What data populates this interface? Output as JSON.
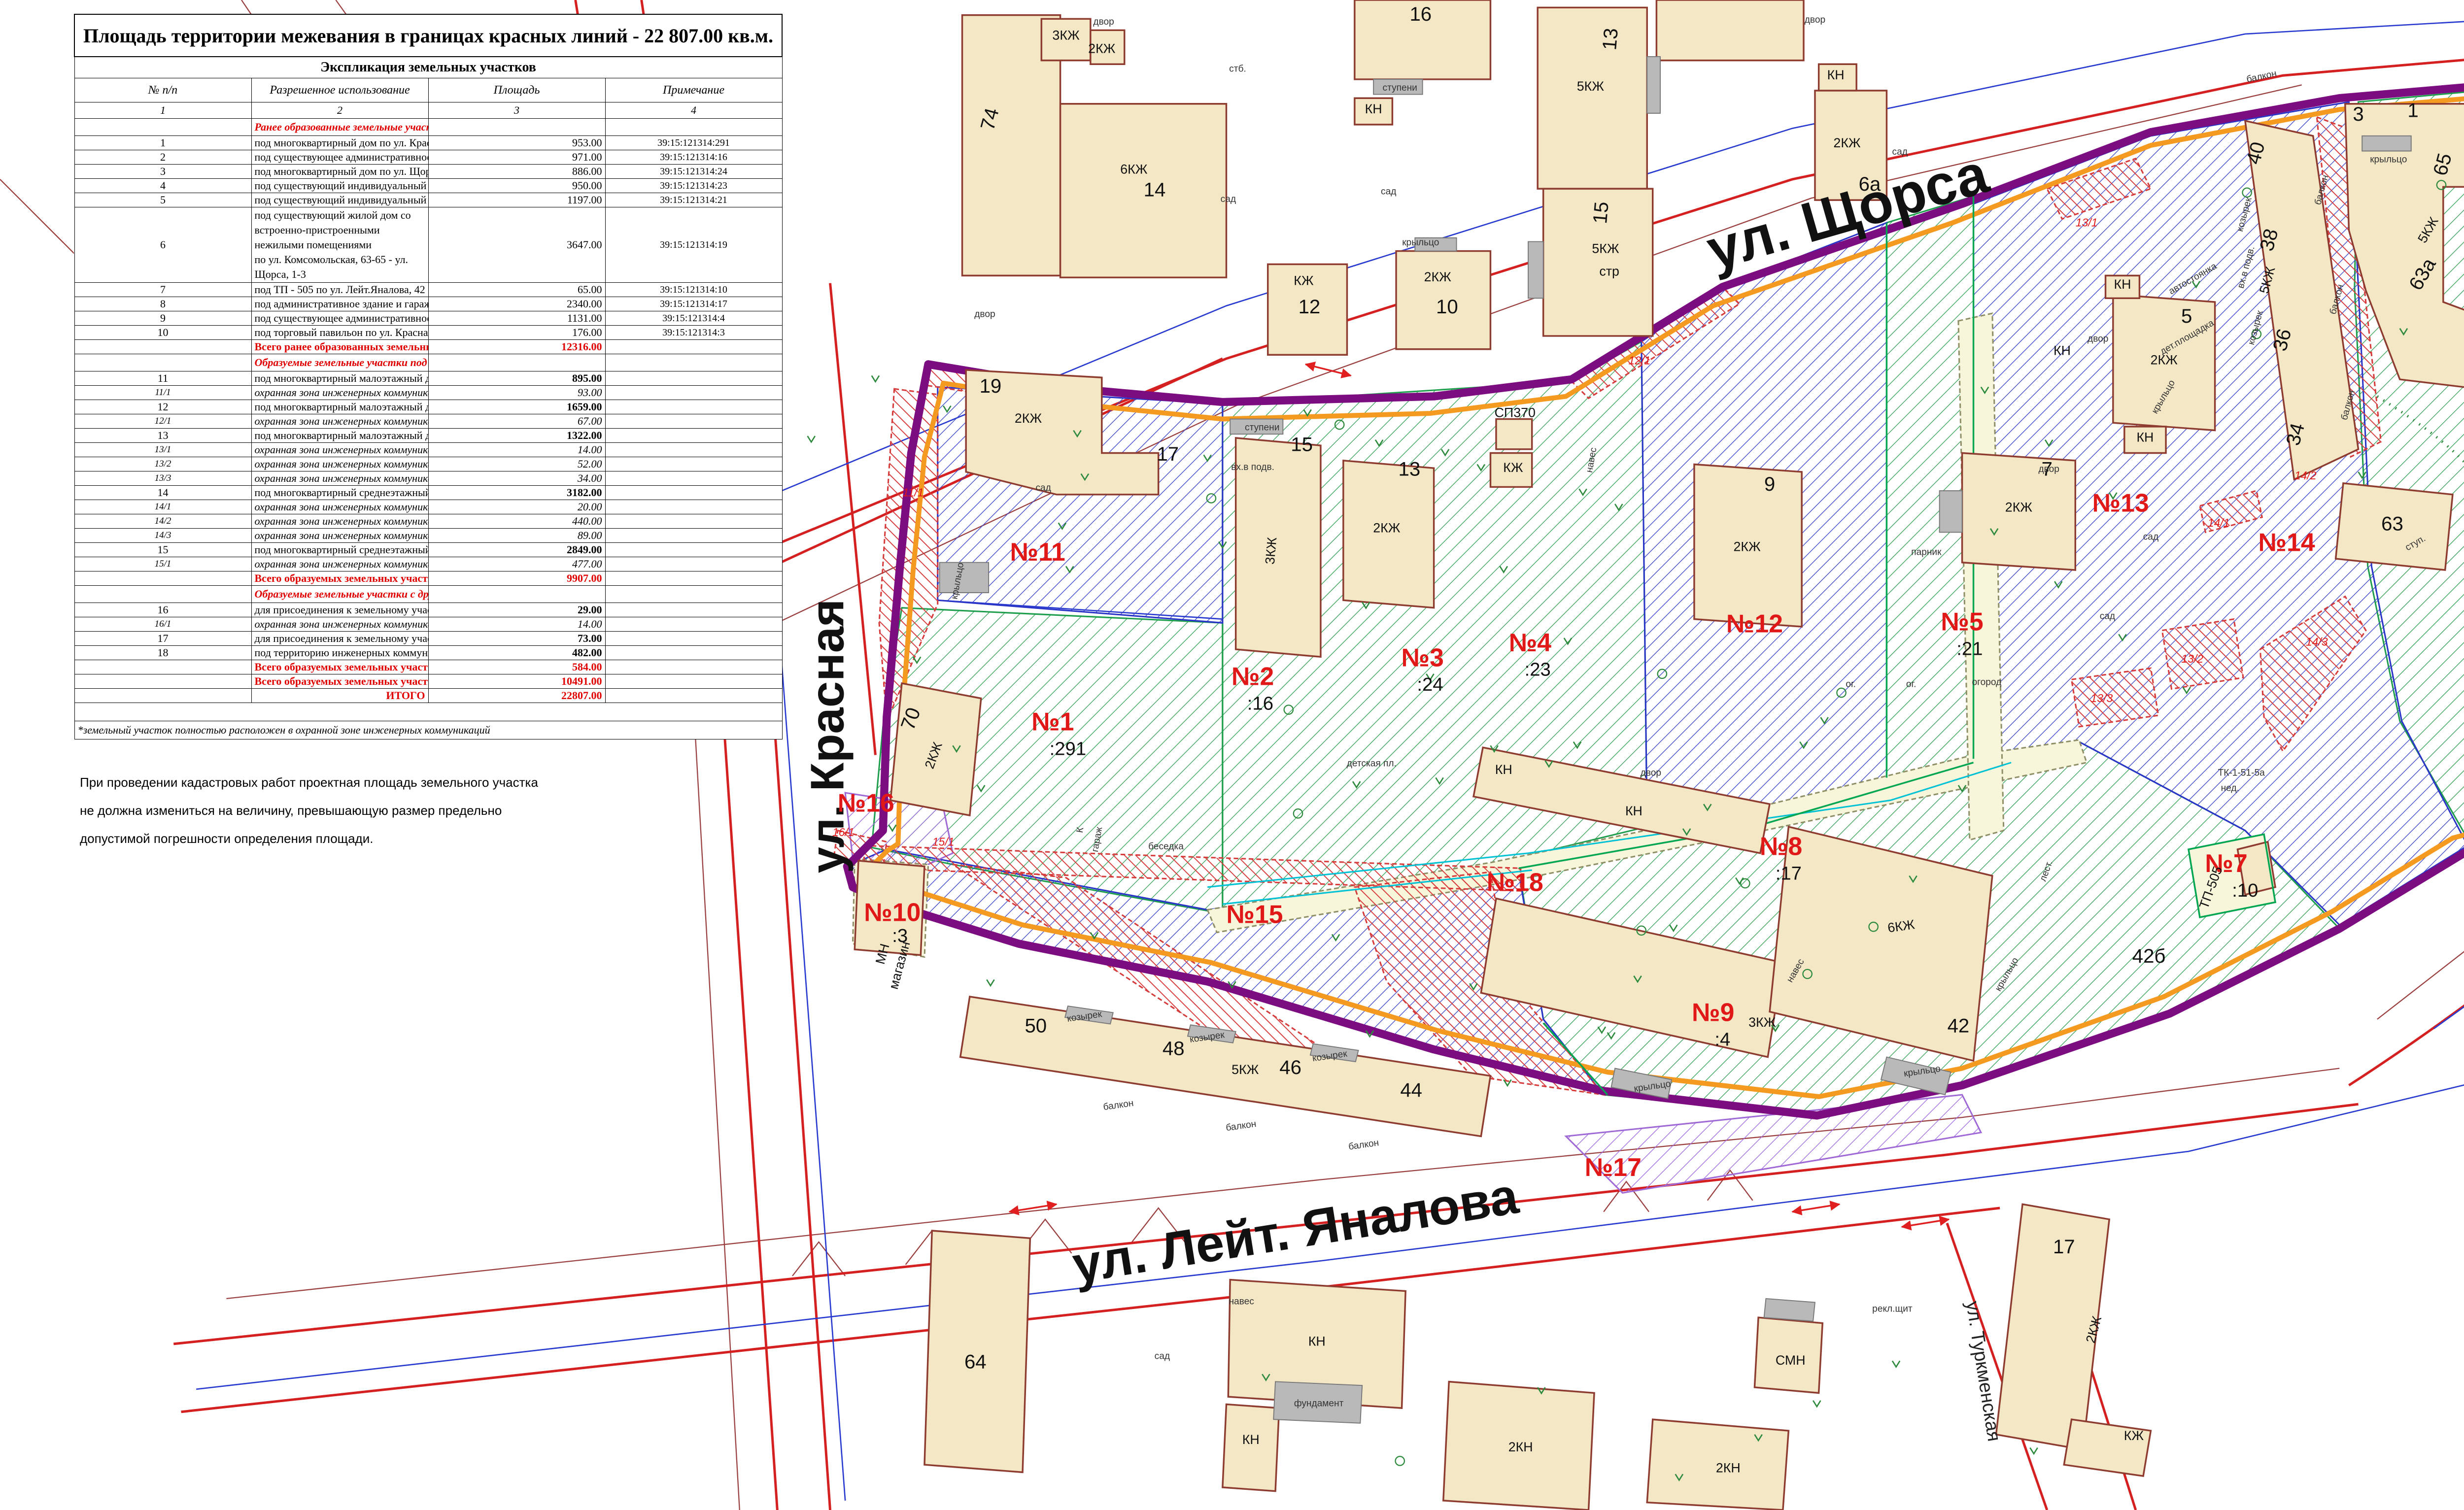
{
  "cadastral_box": {
    "label": "Кадастровый квартал",
    "value": "39:15:121314"
  },
  "table": {
    "title": "Площадь территории межевания в границах красных линий - 22 807.00 кв.м.",
    "subtitle": "Экспликация земельных участков",
    "columns": [
      "№ п/п",
      "Разрешенное использование",
      "Площадь",
      "Примечание"
    ],
    "column_numbers": [
      "1",
      "2",
      "3",
      "4"
    ],
    "rows": [
      {
        "k": "sec",
        "text": "Ранее образованные земельные участки:"
      },
      {
        "k": "r",
        "n": "1",
        "text": "под многоквартирный дом по ул. Красная, 70",
        "a": "953.00",
        "p": "39:15:121314:291"
      },
      {
        "k": "r",
        "n": "2",
        "text": "под существующее административное здание банка по ул. Щорса, 15",
        "a": "971.00",
        "p": "39:15:121314:16"
      },
      {
        "k": "r",
        "n": "3",
        "text": "под многоквартирный дом по ул. Щорса, 13",
        "a": "886.00",
        "p": "39:15:121314:24"
      },
      {
        "k": "r",
        "n": "4",
        "text": "под существующий индивидуальный жилой дом по ул. Щорса, 11",
        "a": "950.00",
        "p": "39:15:121314:23"
      },
      {
        "k": "r",
        "n": "5",
        "text": "под существующий индивидуальный жилой дом по ул. Щорса, 7",
        "a": "1197.00",
        "p": "39:15:121314:21"
      },
      {
        "k": "r2",
        "n": "6",
        "line1": "под существующий жилой дом со встроенно-пристроенными нежилыми помещениями",
        "line2": "по ул. Комсомольская, 63-65 - ул. Щорса, 1-3",
        "a": "3647.00",
        "p": "39:15:121314:19"
      },
      {
        "k": "r",
        "n": "7",
        "text": "под ТП - 505 по ул. Лейт.Яналова, 42",
        "a": "65.00",
        "p": "39:15:121314:10"
      },
      {
        "k": "r",
        "n": "8",
        "text": "под административное здание и гаражи для служебного транспорта по ул. Лейт.Яналова, 42",
        "a": "2340.00",
        "p": "39:15:121314:17"
      },
      {
        "k": "r",
        "n": "9",
        "text": "под существующее административное здание по ул. Лейт.Яналова, 42",
        "a": "1131.00",
        "p": "39:15:121314:4"
      },
      {
        "k": "r",
        "n": "10",
        "text": "под торговый павильон по ул. Красная - ул. Лейт.Яналова",
        "a": "176.00",
        "p": "39:15:121314:3"
      },
      {
        "k": "tot",
        "text": "Всего ранее образованных земельных участков",
        "a": "12316.00"
      },
      {
        "k": "sec",
        "text": "Образуемые земельные участки под многоквартирные дома, в т.ч.:"
      },
      {
        "k": "rb",
        "n": "11",
        "text": "под многоквартирный малоэтажный дом по ул. Щорса, 17-19",
        "a": "895.00"
      },
      {
        "k": "sub",
        "n": "11/1",
        "text": "охранная зона инженерных коммуникаций",
        "a": "93.00"
      },
      {
        "k": "rb",
        "n": "12",
        "text": "под многоквартирный малоэтажный дом по ул. Щорса, 9",
        "a": "1659.00"
      },
      {
        "k": "sub",
        "n": "12/1",
        "text": "охранная зона инженерных коммуникаций",
        "a": "67.00"
      },
      {
        "k": "rb",
        "n": "13",
        "text": "под многоквартирный малоэтажный дом по ул. Щорса, 5",
        "a": "1322.00"
      },
      {
        "k": "sub",
        "n": "13/1",
        "text": "охранная зона инженерных коммуникаций",
        "a": "14.00"
      },
      {
        "k": "sub",
        "n": "13/2",
        "text": "охранная зона инженерных коммуникаций",
        "a": "52.00"
      },
      {
        "k": "sub",
        "n": "13/3",
        "text": "охранная зона инженерных коммуникаций",
        "a": "34.00"
      },
      {
        "k": "rb",
        "n": "14",
        "text": "под многоквартирный среднеэтажный дом по ул. Лейт.Яналова, 34-40",
        "a": "3182.00"
      },
      {
        "k": "sub",
        "n": "14/1",
        "text": "охранная зона инженерных коммуникаций",
        "a": "20.00"
      },
      {
        "k": "sub",
        "n": "14/2",
        "text": "охранная зона инженерных коммуникаций",
        "a": "440.00"
      },
      {
        "k": "sub",
        "n": "14/3",
        "text": "охранная зона инженерных коммуникаций",
        "a": "89.00"
      },
      {
        "k": "rb",
        "n": "15",
        "text": "под многоквартирный среднеэтажный дом по ул. Лейт.Яналова, 44-50",
        "a": "2849.00"
      },
      {
        "k": "sub",
        "n": "15/1",
        "text": "охранная зона инженерных коммуникаций",
        "a": "477.00"
      },
      {
        "k": "tot",
        "text": "Всего образуемых земельных участков под многоквартирные дома",
        "a": "9907.00"
      },
      {
        "k": "sec",
        "text": "Образуемые земельные участки с другим разрешённым использованием, в т.ч.:"
      },
      {
        "k": "rb",
        "n": "16",
        "text": "для присоединения к земельному участку с кадастровым номером 39:15:121314:291 по ул. Красная",
        "a": "29.00"
      },
      {
        "k": "sub",
        "n": "16/1",
        "text": "охранная зона инженерных коммуникаций",
        "a": "14.00"
      },
      {
        "k": "rb",
        "n": "17",
        "text": "для присоединения к земельному участку с кадастровым номером 39:15:121314:4 по ул. Лейт.Яналова",
        "a": "73.00"
      },
      {
        "k": "rb",
        "n": "18",
        "text": "под территорию инженерных коммуникаций по ул. Щорса - ул. Лейт.Яналова",
        "a": "482.00"
      },
      {
        "k": "tot",
        "text": "Всего образуемых земельных участков с другим разрешённым использованием",
        "a": "584.00"
      },
      {
        "k": "tot",
        "text": "Всего образуемых земельных участков",
        "a": "10491.00"
      },
      {
        "k": "tot",
        "text": "ИТОГО",
        "a": "22807.00"
      },
      {
        "k": "blank"
      },
      {
        "k": "foot",
        "text": "*земельный участок полностью расположен в охранной зоне инженерных коммуникаций"
      }
    ]
  },
  "note_below": {
    "lines": [
      "При проведении кадастровых работ проектная площадь земельного участка",
      "не должна измениться на величину, превышающую размер предельно",
      "допустимой погрешности определения площади."
    ]
  },
  "legend": {
    "title": "УСЛОВНЫЕ ОБОЗНАЧЕНИЯ:",
    "items": [
      {
        "type": "line",
        "color": "#e22020",
        "w": 2,
        "label": "- красные линии"
      },
      {
        "type": "line",
        "color": "#7c0d80",
        "w": 7,
        "label": "- граница территории межевания"
      },
      {
        "type": "line",
        "color": "#f49a20",
        "w": 7,
        "label": "- линия отступа от красных линий"
      },
      {
        "type": "line",
        "color": "#3b4fd0",
        "w": 1.6,
        "label": "- граница кадастрового квартала"
      },
      {
        "type": "header",
        "label": "ЗЕМЕЛЬНЫЕ УЧАСТКИ:"
      },
      {
        "type": "hatch",
        "stroke": "#1f9e4d",
        "line": "#35a257",
        "label": "- ранее учтенные земельные участки"
      },
      {
        "type": "hatch",
        "stroke": "#2a35c8",
        "line": "#3946c8",
        "label": "- под существующие жилые здания"
      },
      {
        "type": "hatch",
        "stroke": "#9f6ad6",
        "line": "#a06ae0",
        "label": "- для целей, не связанных со строительством"
      },
      {
        "type": "fill",
        "fill": "#f8f6da",
        "stroke": "#8f8f68",
        "label": "- территория инженерных коммуникаций"
      },
      {
        "type": "header",
        "label": "ЧАСТИ ЗЕМЕЛЬНЫХ УЧАСТКОВ:"
      },
      {
        "type": "hatch",
        "stroke": "#d63c3c",
        "line": "#d63c3c",
        "dashed": true,
        "label": "- охранная зона инженерных коммуникаций"
      }
    ]
  },
  "map": {
    "street_labels": [
      [
        "ул. Щорса",
        982,
        122,
        "st",
        -16
      ],
      [
        "ул. Комсомольская",
        1549,
        152,
        "st2",
        90
      ],
      [
        "ул. Красная",
        447,
        390,
        "st2",
        -90
      ],
      [
        "ул. Лейт. Яналова",
        688,
        661,
        "st3",
        -9
      ],
      [
        "ул. Туркменская",
        1048,
        727,
        "ti2",
        81
      ]
    ],
    "parcel_labels": [
      [
        "№1",
        558,
        387
      ],
      [
        "№2",
        664,
        363
      ],
      [
        "№3",
        754,
        353
      ],
      [
        "№4",
        811,
        345
      ],
      [
        "№5",
        1040,
        334
      ],
      [
        "№6",
        1396,
        164
      ],
      [
        "№7",
        1180,
        462
      ],
      [
        "№8",
        944,
        453
      ],
      [
        "№9",
        908,
        541
      ],
      [
        "№10",
        473,
        488
      ],
      [
        "№11",
        550,
        297
      ],
      [
        "№12",
        930,
        335
      ],
      [
        "№13",
        1124,
        271
      ],
      [
        "№14",
        1212,
        292
      ],
      [
        "№15",
        665,
        489
      ],
      [
        "№16",
        459,
        430
      ],
      [
        "№17",
        855,
        623
      ],
      [
        "№18",
        803,
        472
      ]
    ],
    "cad_labels": [
      [
        ":291",
        566,
        400
      ],
      [
        ":16",
        668,
        376
      ],
      [
        ":24",
        758,
        366
      ],
      [
        ":23",
        815,
        358
      ],
      [
        ":21",
        1044,
        347
      ],
      [
        ":19",
        1400,
        178
      ],
      [
        ":10",
        1190,
        475
      ],
      [
        ":17",
        948,
        466
      ],
      [
        ":4",
        913,
        554
      ],
      [
        ":3",
        477,
        499
      ]
    ],
    "red_sub_labels": [
      [
        "11/1",
        484,
        263
      ],
      [
        "12/1",
        869,
        193
      ],
      [
        "13/1",
        1106,
        120
      ],
      [
        "13/2",
        1162,
        351
      ],
      [
        "13/3",
        1114,
        372
      ],
      [
        "14/1",
        1176,
        279
      ],
      [
        "14/2",
        1222,
        254
      ],
      [
        "14/3",
        1228,
        342
      ],
      [
        "15/1",
        500,
        448
      ],
      [
        "16/1",
        447,
        443
      ]
    ],
    "building_numbers": [
      [
        "19",
        525,
        208
      ],
      [
        "17",
        619,
        244
      ],
      [
        "15",
        690,
        239
      ],
      [
        "13",
        747,
        252
      ],
      [
        "9",
        938,
        260
      ],
      [
        "7",
        1085,
        252
      ],
      [
        "5",
        1159,
        171
      ],
      [
        "3",
        1250,
        64
      ],
      [
        "1",
        1279,
        62
      ],
      [
        "12",
        694,
        166
      ],
      [
        "10",
        767,
        166
      ],
      [
        "16",
        753,
        11
      ],
      [
        "14",
        612,
        104
      ],
      [
        "6а",
        991,
        101
      ],
      [
        "64",
        517,
        725
      ],
      [
        "42",
        1038,
        547
      ],
      [
        "50",
        549,
        547
      ],
      [
        "48",
        622,
        559
      ],
      [
        "46",
        684,
        569
      ],
      [
        "44",
        748,
        581
      ],
      [
        "63",
        1268,
        281
      ],
      [
        "17",
        1094,
        664
      ],
      [
        "11",
        1444,
        609,
        -20
      ],
      [
        "74",
        528,
        64,
        -75
      ],
      [
        "70",
        486,
        382,
        -70
      ],
      [
        "65",
        1298,
        88,
        -75
      ],
      [
        "40",
        1199,
        82,
        -75
      ],
      [
        "38",
        1206,
        128,
        -75
      ],
      [
        "36",
        1213,
        181,
        -75
      ],
      [
        "34",
        1220,
        231,
        -75
      ],
      [
        "13",
        857,
        21,
        -85
      ],
      [
        "15",
        852,
        113,
        -85
      ],
      [
        "63а",
        1287,
        147,
        -60
      ],
      [
        "42б",
        1139,
        510
      ]
    ],
    "small_labels": [
      [
        "2КЖ",
        545,
        224
      ],
      [
        "2КЖ",
        735,
        282
      ],
      [
        "2КЖ",
        926,
        292
      ],
      [
        "2КЖ",
        1070,
        271
      ],
      [
        "2КЖ",
        1147,
        193
      ],
      [
        "2КЖ",
        979,
        78
      ],
      [
        "2КЖ",
        762,
        149
      ],
      [
        "2КЖ",
        584,
        28
      ],
      [
        "2КЖ",
        1112,
        705,
        -75
      ],
      [
        "2КЖ",
        497,
        401,
        -70
      ],
      [
        "3КЖ",
        676,
        292,
        -85
      ],
      [
        "3КЖ",
        934,
        544
      ],
      [
        "3КЖ",
        565,
        21
      ],
      [
        "5КЖ",
        843,
        48
      ],
      [
        "5КЖ",
        851,
        134
      ],
      [
        "5КЖ",
        660,
        569
      ],
      [
        "5КЖ",
        1204,
        149,
        -75
      ],
      [
        "5КЖ",
        1289,
        123,
        -60
      ],
      [
        "стр",
        853,
        146
      ],
      [
        "6КЖ",
        601,
        92
      ],
      [
        "6КЖ",
        1008,
        493,
        -8
      ],
      [
        "КЖ",
        691,
        151
      ],
      [
        "КЖ",
        802,
        250
      ],
      [
        "КЖ",
        1131,
        763
      ],
      [
        "КН",
        728,
        60
      ],
      [
        "КН",
        973,
        42
      ],
      [
        "КН",
        1125,
        153
      ],
      [
        "КН",
        1137,
        234
      ],
      [
        "КН",
        866,
        432
      ],
      [
        "КН",
        797,
        410
      ],
      [
        "КН",
        698,
        713
      ],
      [
        "КН",
        663,
        765
      ],
      [
        "КН",
        1436,
        640,
        -20
      ],
      [
        "КН",
        1093,
        188
      ],
      [
        "СМН",
        949,
        723
      ],
      [
        "2КН",
        806,
        769
      ],
      [
        "2КН",
        916,
        780
      ],
      [
        "СП370",
        803,
        221
      ],
      [
        "МН",
        470,
        506,
        -75
      ],
      [
        "магазин",
        479,
        512,
        -75
      ],
      [
        "ТП-505",
        1174,
        471,
        -70
      ]
    ],
    "tiny_labels": [
      [
        "двор",
        522,
        168
      ],
      [
        "двор",
        585,
        13
      ],
      [
        "двор",
        962,
        12
      ],
      [
        "двор",
        875,
        411
      ],
      [
        "двор",
        1112,
        181
      ],
      [
        "двор",
        1086,
        250
      ],
      [
        "сад",
        553,
        260
      ],
      [
        "сад",
        651,
        107
      ],
      [
        "сад",
        736,
        103
      ],
      [
        "сад",
        1007,
        82
      ],
      [
        "сад",
        1140,
        286
      ],
      [
        "сад",
        1117,
        328
      ],
      [
        "сад",
        616,
        720
      ],
      [
        "сад",
        1352,
        80
      ],
      [
        "огород",
        1053,
        363
      ],
      [
        "ог.",
        981,
        364
      ],
      [
        "ог.",
        1013,
        364
      ],
      [
        "парник",
        1021,
        294
      ],
      [
        "детская пл.",
        727,
        406
      ],
      [
        "дет.площадка",
        1160,
        180,
        -30
      ],
      [
        "автостоянка",
        1163,
        149,
        -30
      ],
      [
        "автостоянка",
        1336,
        329,
        -35
      ],
      [
        "ТК-1-51-5а",
        1188,
        411
      ],
      [
        "нед.",
        1182,
        419
      ],
      [
        "рекл.щит",
        1003,
        695
      ],
      [
        "рекл.щит",
        1497,
        422
      ],
      [
        "гараж",
        583,
        445,
        -80
      ],
      [
        "К",
        574,
        440,
        -80
      ],
      [
        "беседка",
        618,
        450
      ],
      [
        "фундамент",
        699,
        745
      ],
      [
        "крыльцо",
        1266,
        86
      ],
      [
        "крыльцо",
        509,
        308,
        -80
      ],
      [
        "крыльцо",
        876,
        577,
        -8
      ],
      [
        "крыльцо",
        1019,
        569,
        -8
      ],
      [
        "крыльцо",
        1065,
        517,
        -60
      ],
      [
        "крыльцо",
        753,
        130
      ],
      [
        "крыльцо",
        1148,
        211,
        -60
      ],
      [
        "козырек",
        575,
        540,
        -8
      ],
      [
        "козырек",
        640,
        551,
        -8
      ],
      [
        "козырек",
        705,
        561,
        -8
      ],
      [
        "козырек",
        1191,
        114,
        -75
      ],
      [
        "козырек",
        1197,
        174,
        -75
      ],
      [
        "балкон",
        593,
        587,
        -8
      ],
      [
        "балкон",
        658,
        598,
        -8
      ],
      [
        "балкон",
        723,
        608,
        -8
      ],
      [
        "балкон",
        1232,
        101,
        -75
      ],
      [
        "балкон",
        1240,
        159,
        -75
      ],
      [
        "балкон",
        1246,
        215,
        -75
      ],
      [
        "балкон",
        1199,
        42,
        -12
      ],
      [
        "лест.",
        1086,
        462,
        -70
      ],
      [
        "ступени",
        742,
        48
      ],
      [
        "ступени",
        669,
        228
      ],
      [
        "стб.",
        656,
        38
      ],
      [
        "ступ.",
        1281,
        289,
        -30
      ],
      [
        "вх.в подв.",
        664,
        249
      ],
      [
        "вх.в подв.",
        1192,
        142,
        -75
      ],
      [
        "навес",
        953,
        515,
        -60
      ],
      [
        "навес",
        845,
        244,
        -80
      ],
      [
        "навес",
        658,
        691
      ]
    ]
  }
}
